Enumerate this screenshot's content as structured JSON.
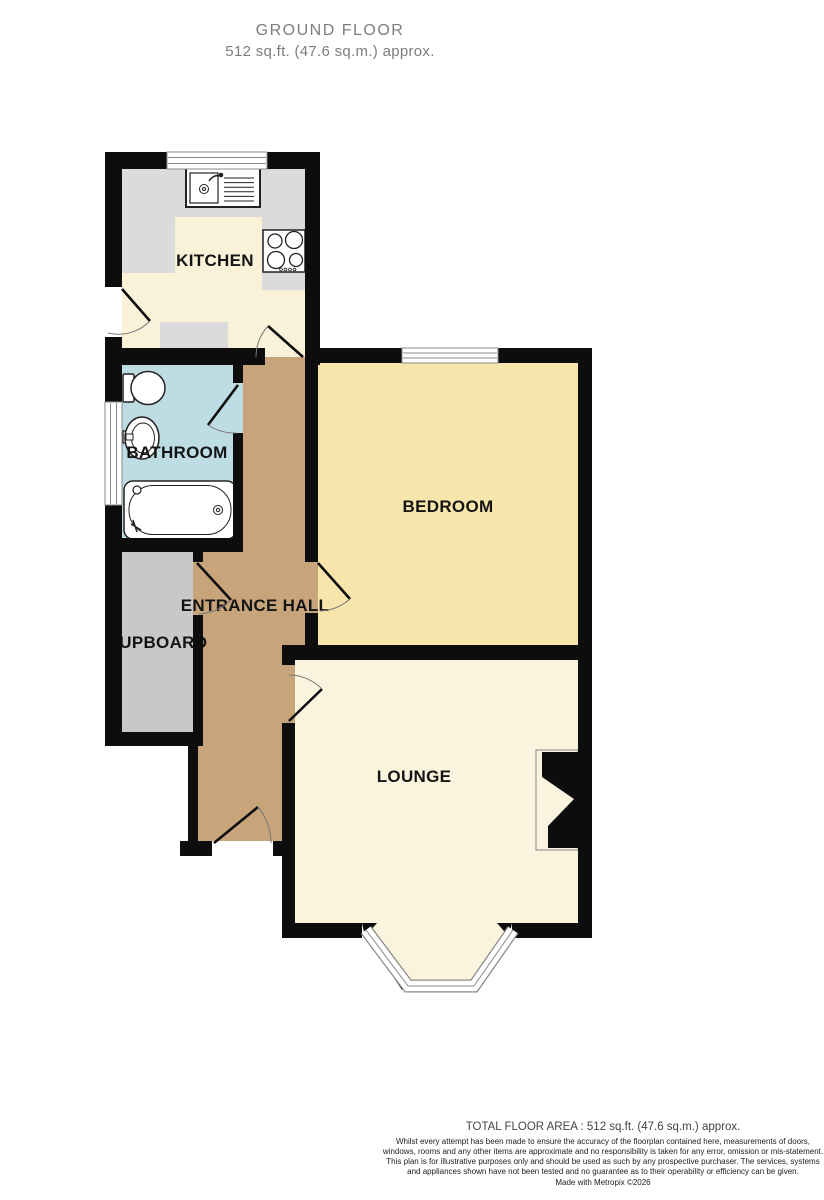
{
  "title": {
    "line1": "GROUND FLOOR",
    "line2": "512 sq.ft. (47.6 sq.m.) approx."
  },
  "rooms": {
    "kitchen": {
      "label": "KITCHEN",
      "floor_color": "#faf2d8"
    },
    "bathroom": {
      "label": "BATHROOM",
      "floor_color": "#bedce4"
    },
    "bedroom": {
      "label": "BEDROOM",
      "floor_color": "#f8e5ac"
    },
    "entrance_hall": {
      "label": "ENTRANCE HALL",
      "floor_color": "#c8a47b"
    },
    "cupboard": {
      "label": "CUPBOARD",
      "floor_color": "#c8c8c8"
    },
    "lounge": {
      "label": "LOUNGE",
      "floor_color": "#faf3de"
    }
  },
  "colors": {
    "wall": "#0d0d0d",
    "counter": "#dbdbdb",
    "label_text": "#141414",
    "title_text": "#7d7d7d",
    "window_stroke": "#8a8a8a"
  },
  "fixtures": [
    "sink-icon",
    "hob-icon",
    "toilet-icon",
    "basin-icon",
    "bathtub-icon",
    "fireplace-icon",
    "bay-window-icon"
  ],
  "footer": {
    "total_area": "TOTAL FLOOR AREA : 512 sq.ft. (47.6 sq.m.) approx.",
    "disclaimer": "Whilst every attempt has been made to ensure the accuracy of the floorplan contained here, measurements of doors, windows, rooms and any other items are approximate and no responsibility is taken for any error, omission or mis-statement. This plan is for illustrative purposes only and should be used as such by any prospective purchaser. The services, systems and appliances shown have not been tested and no guarantee as to their operability or efficiency can be given.",
    "credit": "Made with Metropix ©2026"
  }
}
